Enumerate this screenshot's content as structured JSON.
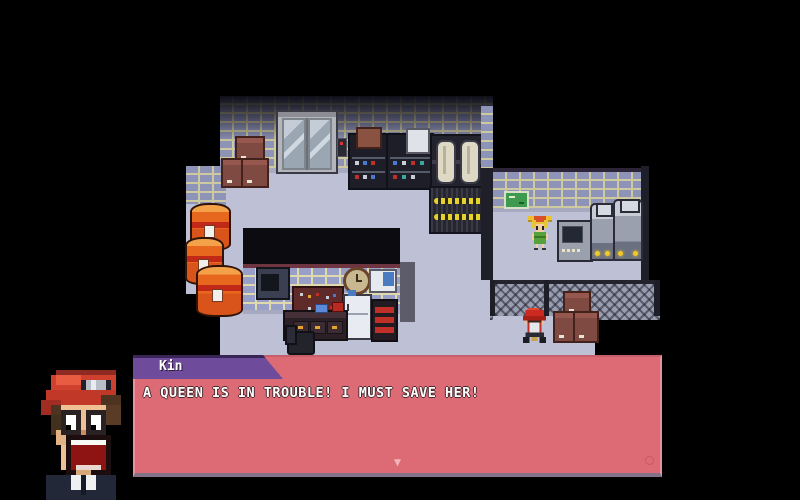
{
  "window": {
    "width": 800,
    "height": 500
  },
  "dialog": {
    "speaker": "Kin",
    "text": "A QUEEN IS IN TROUBLE! I MUST SAVE HER!",
    "advance_arrow": "▼",
    "colors": {
      "box": "#dd6b75",
      "name_tag": "#6f4b9c",
      "name_tag_border": "#3a2656",
      "text": "#ffffff",
      "bottom_border": "#847288",
      "arrow": "#f2b4ba"
    }
  },
  "portrait": {
    "character": "Kin",
    "style": "shocked-boy-with-red-cap-and-goggles"
  },
  "scene": {
    "npcs": [
      {
        "id": "girl-npc",
        "style": "orange-pigtails-green-dress"
      },
      {
        "id": "kid-npc",
        "style": "red-cap-child"
      }
    ],
    "objects": [
      "elevator",
      "cardboard-boxes",
      "storage-shelves",
      "white-machine",
      "cryo-tubes",
      "hazard-cabinet",
      "oil-barrels",
      "counter-window",
      "microwave",
      "pegboard",
      "wall-clock",
      "wall-cabinet",
      "refrigerator",
      "red-rack",
      "desk",
      "office-chair",
      "exit-sign",
      "computer-terminal",
      "robot-machine",
      "chain-link-fence"
    ],
    "colors": {
      "background": "#000000",
      "floor": "#bec1d5",
      "brick": "#8e94b8",
      "mortar": "#cfc9a0",
      "fence": "#989db0",
      "barrel": "#e8671e"
    }
  }
}
